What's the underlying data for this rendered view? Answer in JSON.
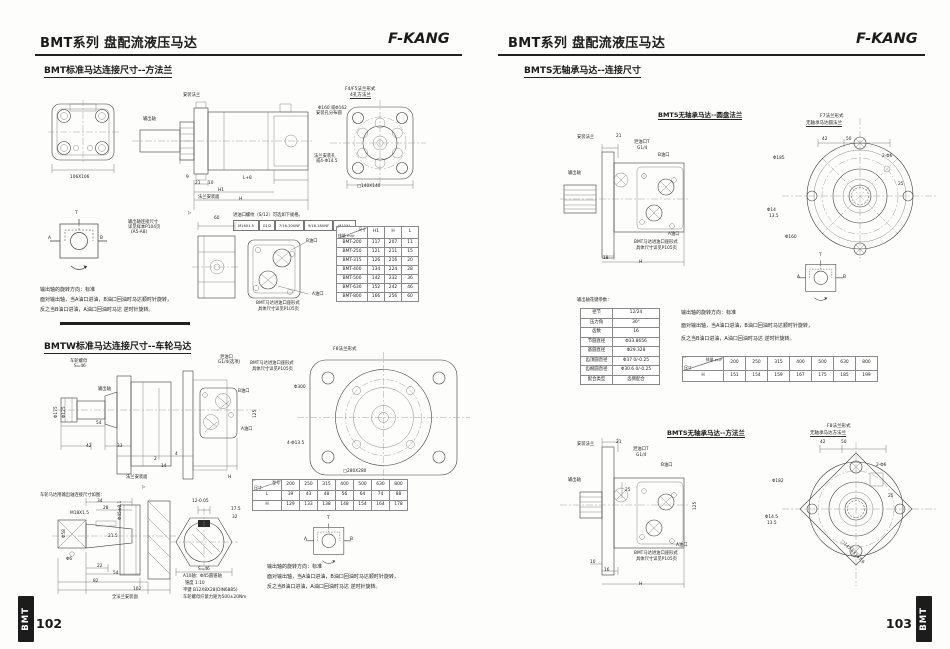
{
  "page_title": "BMT系列 盘配流液压马达",
  "brand": "F-KANG",
  "marker": "▷",
  "hyd": {
    "a": "A",
    "b": "B",
    "t": "T"
  },
  "port_caption": {
    "l1": "BMT马达进油口座形式",
    "l2": "具体尺寸详见P105页"
  },
  "rotation": {
    "l1": "输出轴的旋转方向：标准",
    "l2": "面对输出轴，当A油口进油，B油口回油时马达顺时针旋转，",
    "l3": "反之当B油口进油，A油口回油时马达 逆时针旋转。"
  },
  "left": {
    "page_number": "102",
    "tab": "BMT",
    "sec1": "BMT标准马达连接尺寸--方法兰",
    "sec2": "BMTW标准马达连接尺寸--车轮马达",
    "d1": {
      "flange_dim": "106X106",
      "mount_flange": "安装法兰",
      "output_shaft": "输出轴",
      "note1": "输出轴连接尺寸",
      "note2": "详见样本P104页",
      "note3": "(A5-A8)",
      "d9": "9",
      "d21": "21",
      "d10": "10",
      "l8": "L+8",
      "h1": "H1",
      "h": "H",
      "d60": "60",
      "face": "法兰安装面",
      "f45_cap1": "F4/F5法兰形式",
      "f45_cap2": "4孔方法兰",
      "bcd1": "Φ160 或Φ162",
      "bcd2": "安装孔分布圆",
      "holes1": "法兰安装孔",
      "holes2": "或4-Φ14.5",
      "sq": "□140X140",
      "thread_note": "进油口螺纹（S/12）可选如下规格。",
      "threads": [
        "M16X1.5",
        "G1/2",
        "7/16-20UNF",
        "9/16-18UNF",
        "M10X1"
      ],
      "port_b": "B油口",
      "port_a": "A油口"
    },
    "table1": {
      "corner_top": "尺寸",
      "corner_bottom": "排量 ml/r",
      "cols": [
        "H1",
        "H",
        "L"
      ],
      "rows": [
        [
          "BMT-200",
          "117",
          "207",
          "11"
        ],
        [
          "BMT-250",
          "121",
          "211",
          "15"
        ],
        [
          "BMT-315",
          "126",
          "216",
          "20"
        ],
        [
          "BMT-400",
          "134",
          "224",
          "28"
        ],
        [
          "BMT-500",
          "142",
          "232",
          "36"
        ],
        [
          "BMT-630",
          "152",
          "242",
          "46"
        ],
        [
          "BMT-800",
          "166",
          "256",
          "60"
        ]
      ]
    },
    "d2": {
      "nut1": "车轮螺母",
      "nut2": "S=46",
      "output_shaft": "输出轴",
      "drain1": "泄油口",
      "drain2": "G1/4(选项)",
      "port_b": "B油口",
      "port_a": "A油口",
      "p175": "Φ175",
      "p125": "Φ125",
      "d54": "54",
      "d42": "42",
      "d33": "33",
      "d2": "2",
      "d4": "4",
      "d14": "14",
      "d125": "125",
      "h": "H",
      "face": "法兰安装面",
      "f8_cap": "F8法兰形式",
      "bcd": "Φ300",
      "holes": "4-Φ13.5",
      "sq": "□280X280"
    },
    "table2": {
      "corner_top": "型号",
      "corner_bottom": "尺寸",
      "cols": [
        "200",
        "250",
        "315",
        "400",
        "500",
        "630",
        "800"
      ],
      "rows": [
        [
          "L",
          "39",
          "43",
          "48",
          "56",
          "64",
          "74",
          "88"
        ],
        [
          "H",
          "129",
          "133",
          "138",
          "148",
          "154",
          "164",
          "178"
        ]
      ]
    },
    "d3": {
      "note": "车轮马达用输出轴连接尺寸如图：",
      "d34": "34",
      "d28": "28",
      "p45": "Φ45±0.1",
      "p58": "Φ58",
      "m18": "M18X1.5",
      "d215": "21.5",
      "p6": "Φ6",
      "d22": "22",
      "d54": "54",
      "d82": "82",
      "d102": "102",
      "face": "全法兰安装面",
      "k12": "12-0.05",
      "k175": "17.5",
      "k32": "32",
      "s46": "S=46",
      "a1": "A10轴：Φ45圆锥轴",
      "a2": "锥度 1:10",
      "a3": "平键 B12X8X28(DIN6885)",
      "a4": "车轮螺母拧紧力矩为500±20Nm"
    }
  },
  "right": {
    "page_number": "103",
    "tab": "BMT",
    "sec": "BMTS无轴承马达--连接尺寸",
    "sub1": "BMTS无轴承马达--圆盘法兰",
    "sub2": "BMTS无轴承马达--方法兰",
    "d4": {
      "mount_flange": "安装法兰",
      "drain1": "泄油口T",
      "drain2": "G1/4",
      "output_shaft": "输出轴",
      "port_b": "B油口",
      "port_a": "A油口",
      "d21": "21",
      "d18": "18",
      "h": "H",
      "cap1": "F7法兰形式",
      "cap2": "无轴承马达圆法兰",
      "d42": "42",
      "d50": "50",
      "p185": "Φ185",
      "pins": "2-Φ6",
      "d25": "25",
      "h1": "Φ14",
      "h2": "13.5",
      "p160": "Φ160"
    },
    "spline": {
      "title": "输出轴花键参数：",
      "rows": [
        [
          "径节",
          "12/24"
        ],
        [
          "压力角",
          "30°"
        ],
        [
          "齿数",
          "16"
        ],
        [
          "节圆直径",
          "Φ33.8656"
        ],
        [
          "基圆直径",
          "Φ29.328"
        ],
        [
          "齿顶圆直径",
          "Φ37 0/-0.25"
        ],
        [
          "齿根圆直径",
          "Φ30.6 0/-0.25"
        ],
        [
          "配合类型",
          "齿侧配合"
        ]
      ]
    },
    "table3": {
      "corner_top": "排量 cc/r",
      "corner_bottom": "尺寸",
      "cols": [
        "200",
        "250",
        "315",
        "400",
        "500",
        "630",
        "800"
      ],
      "rows": [
        [
          "H",
          "151",
          "154",
          "159",
          "167",
          "175",
          "185",
          "199"
        ]
      ]
    },
    "d5": {
      "mount_flange": "安装法兰",
      "drain1": "泄油口T",
      "drain2": "G1/4",
      "output_shaft": "输出轴",
      "port_b": "B油口",
      "port_a": "A油口",
      "d21": "21",
      "d25": "25",
      "d10": "10",
      "d16": "16",
      "h": "H",
      "d125": "125",
      "cap1": "F8法兰形式",
      "cap2": "无轴承马达方法兰",
      "d42": "42",
      "d50": "50",
      "p182": "Φ182",
      "pins": "2-Φ6",
      "dd25": "25",
      "h1": "Φ14.5",
      "h2": "13.5",
      "sq": "□147.6X147.6"
    }
  }
}
